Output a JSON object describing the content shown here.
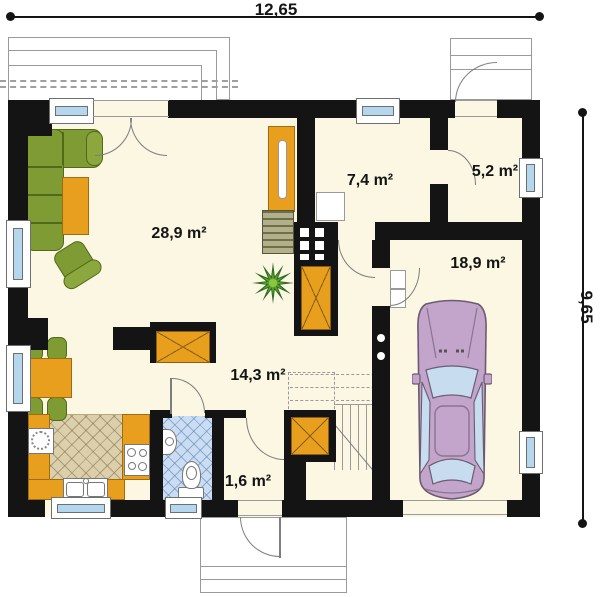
{
  "title": "house-ground-floor-plan",
  "dimensions": {
    "width_label": "12,65",
    "height_label": "9,65"
  },
  "rooms": {
    "living": {
      "area_label": "28,9 m²"
    },
    "utility": {
      "area_label": "7,4 m²"
    },
    "side_entry": {
      "area_label": "5,2 m²"
    },
    "garage": {
      "area_label": "18,9 m²"
    },
    "hall": {
      "area_label": "14,3 m²"
    },
    "vestibule": {
      "area_label": "1,6 m²"
    }
  },
  "colors": {
    "wall": "#141414",
    "floor": "#FBF7E3",
    "furniture_green": "#7E9C33",
    "furniture_orange": "#E89F1E",
    "kitchen_tile": "#DCCFAC",
    "bath_tile": "#CBDDF2",
    "window_glass": "#B5D7EE",
    "car_body": "#C3A4CB",
    "car_glass": "#C7DDEF"
  }
}
